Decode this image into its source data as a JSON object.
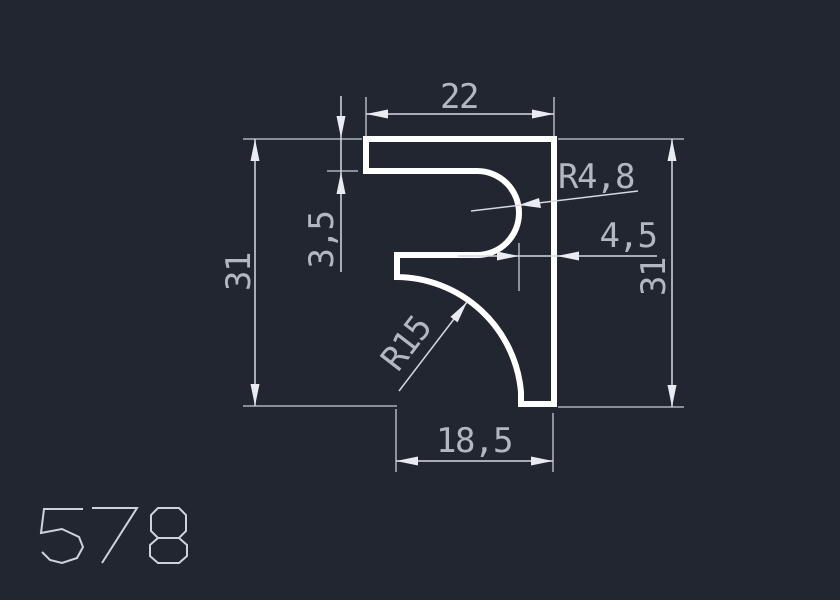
{
  "drawing": {
    "profile_number": "578",
    "dimensions": {
      "top_width": "22",
      "flange_thickness": "3,5",
      "slot_radius": "R4,8",
      "right_wall_thickness": "4,5",
      "left_height": "31",
      "right_height": "31",
      "cove_radius": "R15",
      "bottom_width": "18,5"
    },
    "colors": {
      "background": "#222631",
      "profile_outline": "#ffffff",
      "dimension_lines": "#d4d9e0",
      "dimension_text": "#b2b8c2"
    }
  }
}
